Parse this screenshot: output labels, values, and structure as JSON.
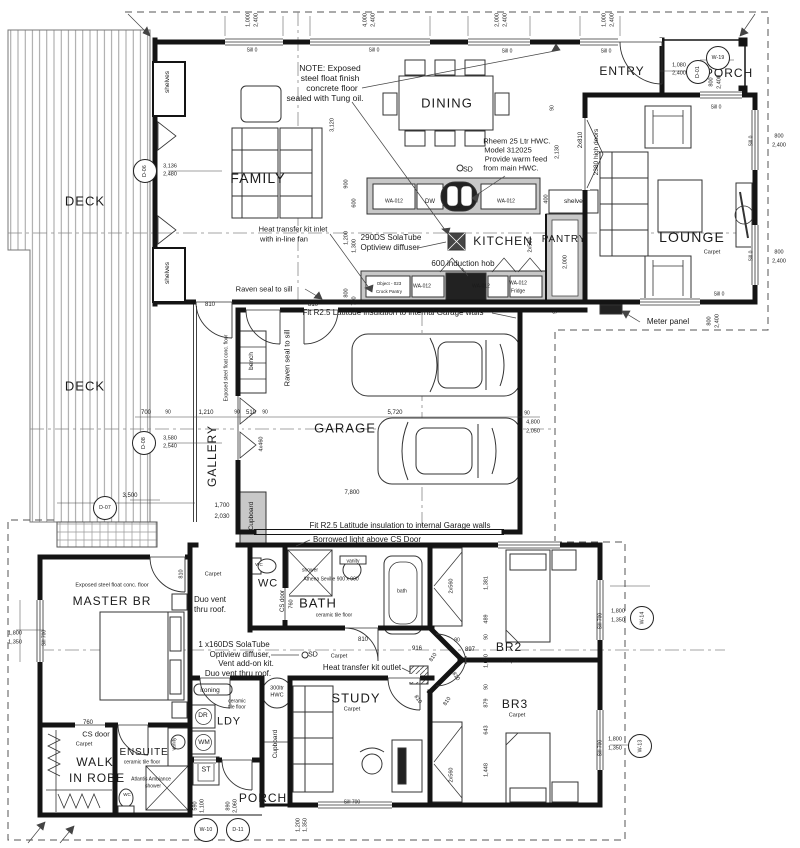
{
  "drawing": {
    "type": "architectural-floor-plan",
    "paper_color": "#ffffff",
    "ink_color": "#1a1a1a",
    "bench_fill": "#c8c8c8",
    "deck_line_color": "#8a8a8a"
  },
  "labels": [
    {
      "t": "FAMILY",
      "x": 258,
      "y": 178,
      "s": 14,
      "n": "room-family"
    },
    {
      "t": "DINING",
      "x": 447,
      "y": 103,
      "s": 13,
      "n": "room-dining"
    },
    {
      "t": "KITCHEN",
      "x": 503,
      "y": 241,
      "s": 12,
      "n": "room-kitchen"
    },
    {
      "t": "PANTRY",
      "x": 564,
      "y": 240,
      "s": 10,
      "n": "room-pantry"
    },
    {
      "t": "LOUNGE",
      "x": 692,
      "y": 237,
      "s": 14,
      "n": "room-lounge"
    },
    {
      "t": "ENTRY",
      "x": 622,
      "y": 71,
      "s": 12,
      "n": "room-entry"
    },
    {
      "t": "PORCH",
      "x": 729,
      "y": 73,
      "s": 12,
      "n": "room-porch-top"
    },
    {
      "t": "DECK",
      "x": 85,
      "y": 201,
      "s": 13,
      "n": "room-deck-upper"
    },
    {
      "t": "DECK",
      "x": 85,
      "y": 386,
      "s": 13,
      "n": "room-deck-lower"
    },
    {
      "t": "GALLERY",
      "x": 212,
      "y": 456,
      "s": 12,
      "r": -90,
      "n": "room-gallery"
    },
    {
      "t": "GARAGE",
      "x": 345,
      "y": 428,
      "s": 13,
      "n": "room-garage"
    },
    {
      "t": "MASTER BR",
      "x": 112,
      "y": 601,
      "s": 12,
      "n": "room-master-br"
    },
    {
      "t": "WALK",
      "x": 95,
      "y": 762,
      "s": 12,
      "n": "room-walk-in-robe"
    },
    {
      "t": "IN ROBE",
      "x": 97,
      "y": 778,
      "s": 12,
      "n": "room-walk-in-robe-2"
    },
    {
      "t": "ENSUITE",
      "x": 144,
      "y": 753,
      "s": 10,
      "n": "room-ensuite"
    },
    {
      "t": "WC",
      "x": 268,
      "y": 584,
      "s": 11,
      "n": "room-wc"
    },
    {
      "t": "BATH",
      "x": 318,
      "y": 603,
      "s": 13,
      "n": "room-bath"
    },
    {
      "t": "LDY",
      "x": 229,
      "y": 722,
      "s": 11,
      "n": "room-ldy"
    },
    {
      "t": "STUDY",
      "x": 356,
      "y": 698,
      "s": 13,
      "n": "room-study"
    },
    {
      "t": "BR2",
      "x": 509,
      "y": 647,
      "s": 12,
      "n": "room-br2"
    },
    {
      "t": "BR3",
      "x": 515,
      "y": 704,
      "s": 12,
      "n": "room-br3"
    },
    {
      "t": "PORCH",
      "x": 263,
      "y": 798,
      "s": 12,
      "n": "room-porch-bottom"
    },
    {
      "t": "Carpet",
      "x": 712,
      "y": 253,
      "s": 5.5
    },
    {
      "t": "Carpet",
      "x": 213,
      "y": 575,
      "s": 5.5
    },
    {
      "t": "Carpet",
      "x": 339,
      "y": 657,
      "s": 5.5
    },
    {
      "t": "Carpet",
      "x": 84,
      "y": 745,
      "s": 5.5
    },
    {
      "t": "Carpet",
      "x": 510,
      "y": 662,
      "s": 5.5
    },
    {
      "t": "Carpet",
      "x": 517,
      "y": 716,
      "s": 5.5
    },
    {
      "t": "Carpet",
      "x": 352,
      "y": 710,
      "s": 5.5
    },
    {
      "t": "ceramic tile floor",
      "x": 334,
      "y": 616,
      "s": 5
    },
    {
      "t": "ceramic",
      "x": 237,
      "y": 702,
      "s": 5
    },
    {
      "t": "tile floor",
      "x": 237,
      "y": 708,
      "s": 5
    },
    {
      "t": "ceramic tile floor",
      "x": 142,
      "y": 763,
      "s": 5
    },
    {
      "t": "Exposed steel float conc. floor",
      "x": 112,
      "y": 586,
      "s": 5.5
    },
    {
      "t": "Exposed steel float conc. floor",
      "x": 227,
      "y": 368,
      "s": 5,
      "r": -90
    },
    {
      "t": "NOTE: Exposed",
      "x": 330,
      "y": 68,
      "s": 8.5,
      "n": "note-floor-finish"
    },
    {
      "t": "steel float finish",
      "x": 330,
      "y": 78,
      "s": 8.5
    },
    {
      "t": "concrete floor",
      "x": 332,
      "y": 88,
      "s": 8.5
    },
    {
      "t": "sealed with Tung oil.",
      "x": 325,
      "y": 98,
      "s": 8.5
    },
    {
      "t": "Rheem 25 Ltr HWC.",
      "x": 517,
      "y": 141,
      "s": 7.5,
      "n": "note-hwc"
    },
    {
      "t": "Model 312025",
      "x": 508,
      "y": 150,
      "s": 7.5
    },
    {
      "t": "Provide warm feed",
      "x": 516,
      "y": 159,
      "s": 7.5
    },
    {
      "t": "from main HWC.",
      "x": 511,
      "y": 168,
      "s": 7.5
    },
    {
      "t": "Heat transfer kit inlet",
      "x": 293,
      "y": 229,
      "s": 7.5,
      "n": "note-heat-inlet"
    },
    {
      "t": "with in-line fan",
      "x": 284,
      "y": 239,
      "s": 7.5
    },
    {
      "t": "290DS SolaTube",
      "x": 391,
      "y": 238,
      "s": 8,
      "n": "note-solatube"
    },
    {
      "t": "Optiview diffuser",
      "x": 390,
      "y": 248,
      "s": 8
    },
    {
      "t": "600 induction hob",
      "x": 463,
      "y": 264,
      "s": 8,
      "n": "note-hob"
    },
    {
      "t": "Raven seal to sill",
      "x": 264,
      "y": 289,
      "s": 7.5
    },
    {
      "t": "Raven seal to sill",
      "x": 287,
      "y": 358,
      "s": 7.5,
      "r": -90
    },
    {
      "t": "Fit R2.5 Latitude insulation to internal Garage walls",
      "x": 393,
      "y": 313,
      "s": 8,
      "n": "note-insulation-top"
    },
    {
      "t": "Fit R2.5 Latitude insulation to internal Garage walls",
      "x": 400,
      "y": 526,
      "s": 8,
      "n": "note-insulation-bottom"
    },
    {
      "t": "Borrowed light above CS Door",
      "x": 367,
      "y": 540,
      "s": 8
    },
    {
      "t": "Meter panel",
      "x": 668,
      "y": 322,
      "s": 8,
      "n": "note-meter-panel"
    },
    {
      "t": "Duo vent",
      "x": 210,
      "y": 600,
      "s": 8
    },
    {
      "t": "thru roof.",
      "x": 210,
      "y": 610,
      "s": 8
    },
    {
      "t": "1 x160DS SolaTube",
      "x": 234,
      "y": 645,
      "s": 8,
      "n": "note-solatube-2"
    },
    {
      "t": "Optiview diffuser,",
      "x": 240,
      "y": 655,
      "s": 8
    },
    {
      "t": "Vent add-on kit.",
      "x": 246,
      "y": 664,
      "s": 8
    },
    {
      "t": "Duo vent thru roof.",
      "x": 238,
      "y": 674,
      "s": 8
    },
    {
      "t": "Heat transfer kit outlet",
      "x": 362,
      "y": 668,
      "s": 8,
      "n": "note-heat-outlet"
    },
    {
      "t": "SD",
      "x": 468,
      "y": 170,
      "s": 7
    },
    {
      "t": "SD",
      "x": 313,
      "y": 655,
      "s": 7
    },
    {
      "t": "CS door",
      "x": 96,
      "y": 734,
      "s": 7.5
    },
    {
      "t": "CS door",
      "x": 283,
      "y": 601,
      "s": 6,
      "r": -90
    },
    {
      "t": "760",
      "x": 88,
      "y": 723,
      "s": 6
    },
    {
      "t": "760",
      "x": 292,
      "y": 604,
      "s": 5.5,
      "r": -90
    },
    {
      "t": "vanity",
      "x": 353,
      "y": 562,
      "s": 5
    },
    {
      "t": "vanity",
      "x": 175,
      "y": 744,
      "s": 5,
      "r": -90
    },
    {
      "t": "shower",
      "x": 310,
      "y": 571,
      "s": 5
    },
    {
      "t": "Athena Seville 900 x 900",
      "x": 331,
      "y": 580,
      "s": 5
    },
    {
      "t": "Atlantis Ambiance",
      "x": 151,
      "y": 780,
      "s": 5
    },
    {
      "t": "shower",
      "x": 153,
      "y": 787,
      "s": 5
    },
    {
      "t": "bath",
      "x": 402,
      "y": 592,
      "s": 5
    },
    {
      "t": "WC",
      "x": 259,
      "y": 565,
      "s": 4.5
    },
    {
      "t": "WC",
      "x": 127,
      "y": 795,
      "s": 4.5
    },
    {
      "t": "DW",
      "x": 430,
      "y": 202,
      "s": 6
    },
    {
      "t": "sink",
      "x": 457,
      "y": 207,
      "s": 4
    },
    {
      "t": "WA-012",
      "x": 394,
      "y": 202,
      "s": 5
    },
    {
      "t": "WA-012",
      "x": 506,
      "y": 202,
      "s": 5
    },
    {
      "t": "WA-012",
      "x": 422,
      "y": 287,
      "s": 5
    },
    {
      "t": "WA-012",
      "x": 481,
      "y": 287,
      "s": 5
    },
    {
      "t": "WA-012",
      "x": 518,
      "y": 284,
      "s": 5
    },
    {
      "t": "Fridge",
      "x": 518,
      "y": 292,
      "s": 5
    },
    {
      "t": "Object - 023",
      "x": 389,
      "y": 284,
      "s": 4.5
    },
    {
      "t": "Crock Pantry",
      "x": 389,
      "y": 292,
      "s": 4.5
    },
    {
      "t": "shelves",
      "x": 575,
      "y": 202,
      "s": 6.5
    },
    {
      "t": "shelves",
      "x": 168,
      "y": 82,
      "s": 6.5,
      "r": -90
    },
    {
      "t": "shelves",
      "x": 168,
      "y": 273,
      "s": 6.5,
      "r": -90
    },
    {
      "t": "bench",
      "x": 252,
      "y": 361,
      "s": 6.5,
      "r": -90
    },
    {
      "t": "Cupboard",
      "x": 252,
      "y": 516,
      "s": 6.5,
      "r": -90
    },
    {
      "t": "Cupboard",
      "x": 276,
      "y": 744,
      "s": 6.5,
      "r": -90
    },
    {
      "t": "ironing",
      "x": 210,
      "y": 691,
      "s": 6.5
    },
    {
      "t": "DR",
      "x": 203,
      "y": 716,
      "s": 6.5
    },
    {
      "t": "WM",
      "x": 204,
      "y": 743,
      "s": 6.5
    },
    {
      "t": "ST",
      "x": 206,
      "y": 770,
      "s": 7
    },
    {
      "t": "300ltr",
      "x": 277,
      "y": 689,
      "s": 5.5
    },
    {
      "t": "HWC",
      "x": 277,
      "y": 696,
      "s": 5.5
    },
    {
      "t": "2x810",
      "x": 581,
      "y": 140,
      "s": 6,
      "r": -90
    },
    {
      "t": "2380 high doors",
      "x": 597,
      "y": 152,
      "s": 6.5,
      "r": -90
    },
    {
      "t": "1,000",
      "x": 249,
      "y": 20,
      "r": -90,
      "s": 5.5
    },
    {
      "t": "2,400",
      "x": 257,
      "y": 20,
      "r": -90,
      "s": 5.5
    },
    {
      "t": "4,000",
      "x": 366,
      "y": 20,
      "r": -90,
      "s": 5.5
    },
    {
      "t": "2,400",
      "x": 374,
      "y": 20,
      "r": -90,
      "s": 5.5
    },
    {
      "t": "2,000",
      "x": 498,
      "y": 20,
      "r": -90,
      "s": 5.5
    },
    {
      "t": "2,400",
      "x": 506,
      "y": 20,
      "r": -90,
      "s": 5.5
    },
    {
      "t": "1,000",
      "x": 605,
      "y": 20,
      "r": -90,
      "s": 5.5
    },
    {
      "t": "2,400",
      "x": 613,
      "y": 20,
      "r": -90,
      "s": 5.5
    },
    {
      "t": "Sill 0",
      "x": 252,
      "y": 51,
      "s": 5
    },
    {
      "t": "Sill 0",
      "x": 374,
      "y": 51,
      "s": 5
    },
    {
      "t": "Sill 0",
      "x": 507,
      "y": 52,
      "s": 5
    },
    {
      "t": "Sill 0",
      "x": 606,
      "y": 52,
      "s": 5
    },
    {
      "t": "1,080",
      "x": 679,
      "y": 66,
      "s": 5.5
    },
    {
      "t": "2,400",
      "x": 679,
      "y": 74,
      "s": 5.5
    },
    {
      "t": "800",
      "x": 712,
      "y": 82,
      "r": -90,
      "s": 5.5
    },
    {
      "t": "2,400",
      "x": 720,
      "y": 82,
      "r": -90,
      "s": 5.5
    },
    {
      "t": "Sill 0",
      "x": 716,
      "y": 108,
      "s": 5
    },
    {
      "t": "Sill 0",
      "x": 752,
      "y": 141,
      "r": -90,
      "s": 5
    },
    {
      "t": "800",
      "x": 779,
      "y": 137,
      "s": 5.5
    },
    {
      "t": "2,400",
      "x": 779,
      "y": 146,
      "s": 5.5
    },
    {
      "t": "Sill 0",
      "x": 752,
      "y": 256,
      "r": -90,
      "s": 5
    },
    {
      "t": "800",
      "x": 779,
      "y": 253,
      "s": 5.5
    },
    {
      "t": "2,400",
      "x": 779,
      "y": 262,
      "s": 5.5
    },
    {
      "t": "Sill 0",
      "x": 719,
      "y": 295,
      "s": 5
    },
    {
      "t": "800",
      "x": 710,
      "y": 321,
      "r": -90,
      "s": 5.5
    },
    {
      "t": "2,400",
      "x": 718,
      "y": 321,
      "r": -90,
      "s": 5.5
    },
    {
      "t": "3,120",
      "x": 333,
      "y": 125,
      "r": -90,
      "s": 5.5
    },
    {
      "t": "2,130",
      "x": 558,
      "y": 152,
      "r": -90,
      "s": 5.5
    },
    {
      "t": "90",
      "x": 553,
      "y": 108,
      "r": -90,
      "s": 5
    },
    {
      "t": "900",
      "x": 347,
      "y": 184,
      "r": -90,
      "s": 5.5
    },
    {
      "t": "600",
      "x": 355,
      "y": 203,
      "r": -90,
      "s": 5.5
    },
    {
      "t": "1,200",
      "x": 347,
      "y": 238,
      "r": -90,
      "s": 5.5
    },
    {
      "t": "1,300",
      "x": 355,
      "y": 246,
      "r": -90,
      "s": 5.5
    },
    {
      "t": "800",
      "x": 347,
      "y": 293,
      "r": -90,
      "s": 5.5
    },
    {
      "t": "700",
      "x": 355,
      "y": 301,
      "r": -90,
      "s": 5.5
    },
    {
      "t": "400",
      "x": 547,
      "y": 199,
      "r": -90,
      "s": 5.5
    },
    {
      "t": "2x560",
      "x": 531,
      "y": 245,
      "r": -90,
      "s": 5.5
    },
    {
      "t": "2,000",
      "x": 566,
      "y": 262,
      "r": -90,
      "s": 5.5
    },
    {
      "t": "810",
      "x": 210,
      "y": 305,
      "s": 6
    },
    {
      "t": "810",
      "x": 313,
      "y": 305,
      "s": 6
    },
    {
      "t": "700",
      "x": 146,
      "y": 413,
      "s": 6
    },
    {
      "t": "90",
      "x": 168,
      "y": 413,
      "s": 5
    },
    {
      "t": "1,210",
      "x": 206,
      "y": 413,
      "s": 6
    },
    {
      "t": "90",
      "x": 237,
      "y": 413,
      "s": 5
    },
    {
      "t": "510",
      "x": 251,
      "y": 413,
      "s": 6
    },
    {
      "t": "90",
      "x": 265,
      "y": 413,
      "s": 5
    },
    {
      "t": "5,720",
      "x": 395,
      "y": 413,
      "s": 6
    },
    {
      "t": "90",
      "x": 527,
      "y": 414,
      "s": 5
    },
    {
      "t": "4x460",
      "x": 262,
      "y": 444,
      "r": -90,
      "s": 5.5
    },
    {
      "t": "7,800",
      "x": 352,
      "y": 493,
      "s": 6
    },
    {
      "t": "1,700",
      "x": 222,
      "y": 506,
      "s": 6
    },
    {
      "t": "2,030",
      "x": 222,
      "y": 517,
      "s": 6
    },
    {
      "t": "3,500",
      "x": 130,
      "y": 496,
      "s": 6
    },
    {
      "t": "4,800",
      "x": 533,
      "y": 423,
      "s": 5.5
    },
    {
      "t": "2,050",
      "x": 533,
      "y": 432,
      "s": 5.5
    },
    {
      "t": "90",
      "x": 556,
      "y": 311,
      "r": -90,
      "s": 5
    },
    {
      "t": "3,136",
      "x": 170,
      "y": 167,
      "s": 5.5
    },
    {
      "t": "2,480",
      "x": 170,
      "y": 175,
      "s": 5.5
    },
    {
      "t": "3,580",
      "x": 170,
      "y": 439,
      "s": 5.5
    },
    {
      "t": "2,540",
      "x": 170,
      "y": 447,
      "s": 5.5
    },
    {
      "t": "1,800",
      "x": 15,
      "y": 634,
      "s": 5.5
    },
    {
      "t": "1,350",
      "x": 15,
      "y": 643,
      "s": 5.5
    },
    {
      "t": "Sill 700",
      "x": 45,
      "y": 638,
      "r": -90,
      "s": 5
    },
    {
      "t": "810",
      "x": 182,
      "y": 574,
      "r": -90,
      "s": 5.5
    },
    {
      "t": "810",
      "x": 363,
      "y": 640,
      "s": 6
    },
    {
      "t": "916",
      "x": 417,
      "y": 649,
      "s": 6
    },
    {
      "t": "897",
      "x": 470,
      "y": 650,
      "s": 6
    },
    {
      "t": "90",
      "x": 457,
      "y": 641,
      "s": 5
    },
    {
      "t": "810",
      "x": 434,
      "y": 658,
      "r": -55,
      "s": 5.5
    },
    {
      "t": "810",
      "x": 455,
      "y": 677,
      "r": 55,
      "s": 5.5
    },
    {
      "t": "810",
      "x": 417,
      "y": 700,
      "r": 55,
      "s": 5.5
    },
    {
      "t": "810",
      "x": 448,
      "y": 702,
      "r": -55,
      "s": 5.5
    },
    {
      "t": "2x560",
      "x": 452,
      "y": 586,
      "r": -90,
      "s": 5.5
    },
    {
      "t": "2x560",
      "x": 452,
      "y": 775,
      "r": -90,
      "s": 5.5
    },
    {
      "t": "1,381",
      "x": 487,
      "y": 583,
      "r": -90,
      "s": 5.5
    },
    {
      "t": "489",
      "x": 487,
      "y": 619,
      "r": -90,
      "s": 5.5
    },
    {
      "t": "90",
      "x": 487,
      "y": 637,
      "r": -90,
      "s": 5
    },
    {
      "t": "1,000",
      "x": 487,
      "y": 661,
      "r": -90,
      "s": 5.5
    },
    {
      "t": "90",
      "x": 487,
      "y": 687,
      "r": -90,
      "s": 5
    },
    {
      "t": "879",
      "x": 487,
      "y": 703,
      "r": -90,
      "s": 5.5
    },
    {
      "t": "643",
      "x": 487,
      "y": 730,
      "r": -90,
      "s": 5.5
    },
    {
      "t": "1,448",
      "x": 487,
      "y": 770,
      "r": -90,
      "s": 5.5
    },
    {
      "t": "1,800",
      "x": 618,
      "y": 612,
      "s": 5.5
    },
    {
      "t": "1,350",
      "x": 618,
      "y": 621,
      "s": 5.5
    },
    {
      "t": "Sill 700",
      "x": 601,
      "y": 621,
      "r": -90,
      "s": 5
    },
    {
      "t": "1,800",
      "x": 615,
      "y": 740,
      "s": 5.5
    },
    {
      "t": "1,350",
      "x": 615,
      "y": 749,
      "s": 5.5
    },
    {
      "t": "Sill 700",
      "x": 601,
      "y": 748,
      "r": -90,
      "s": 5
    },
    {
      "t": "Sill 700",
      "x": 352,
      "y": 803,
      "s": 5
    },
    {
      "t": "1,200",
      "x": 299,
      "y": 825,
      "r": -90,
      "s": 5.5
    },
    {
      "t": "1,350",
      "x": 306,
      "y": 825,
      "r": -90,
      "s": 5.5
    },
    {
      "t": "590",
      "x": 196,
      "y": 806,
      "r": -90,
      "s": 5.5
    },
    {
      "t": "1,100",
      "x": 203,
      "y": 806,
      "r": -90,
      "s": 5.5
    },
    {
      "t": "890",
      "x": 229,
      "y": 806,
      "r": -90,
      "s": 5.5
    },
    {
      "t": "2,060",
      "x": 236,
      "y": 806,
      "r": -90,
      "s": 5.5
    }
  ],
  "tags": [
    {
      "id": "D-06",
      "x": 144,
      "y": 170,
      "rot": 1
    },
    {
      "id": "D-08",
      "x": 143,
      "y": 442,
      "rot": 1
    },
    {
      "id": "D-07",
      "x": 104,
      "y": 507
    },
    {
      "id": "D-01",
      "x": 697,
      "y": 71,
      "rot": 1
    },
    {
      "id": "W-19",
      "x": 717,
      "y": 57
    },
    {
      "id": "W-10",
      "x": 205,
      "y": 829
    },
    {
      "id": "D-11",
      "x": 237,
      "y": 829
    },
    {
      "id": "W-14",
      "x": 641,
      "y": 617,
      "rot": 1
    },
    {
      "id": "W-13",
      "x": 639,
      "y": 745,
      "rot": 1
    }
  ]
}
